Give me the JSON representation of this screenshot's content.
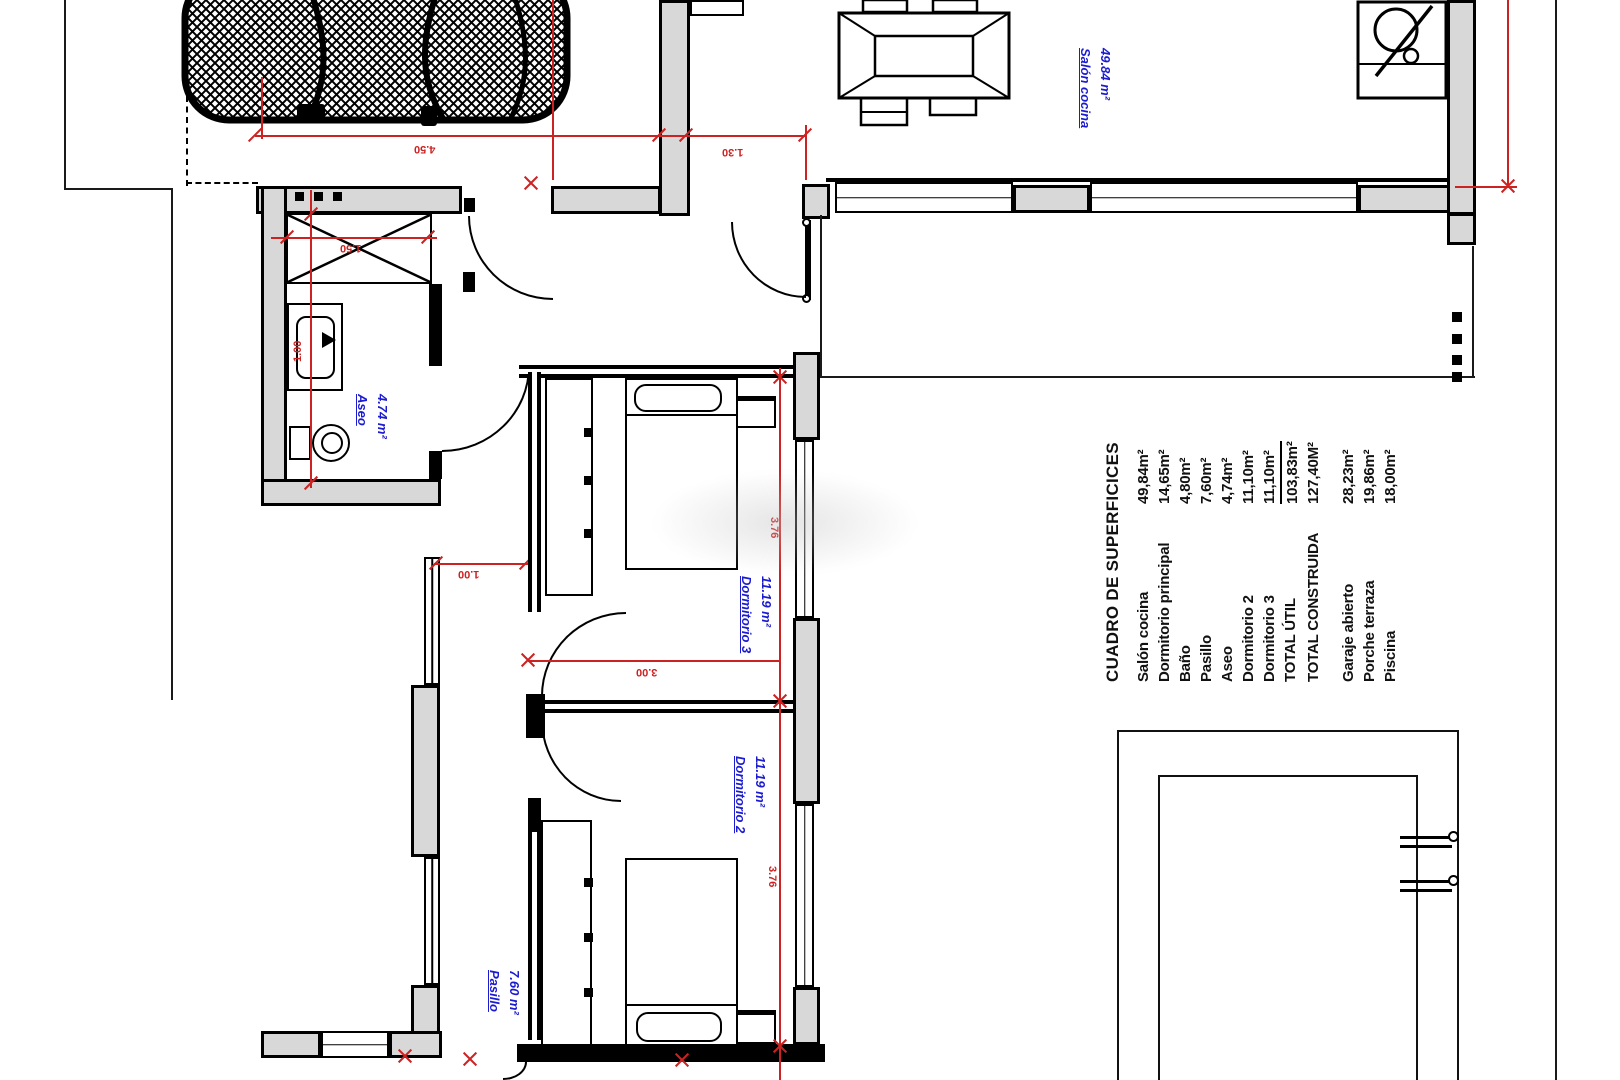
{
  "plan": {
    "rooms": {
      "salon": {
        "name": "Salón cocina",
        "area": "49.84 m²"
      },
      "aseo": {
        "name": "Aseo",
        "area": "4.74 m²"
      },
      "dormitorio3": {
        "name": "Dormitorio 3",
        "area": "11.19 m²"
      },
      "dormitorio2": {
        "name": "Dormitorio 2",
        "area": "11.19 m²"
      },
      "pasillo": {
        "name": "Pasillo",
        "area": "7.60 m²"
      }
    },
    "dimensions": {
      "garage_width": "4.50",
      "entry_width": "1.30",
      "shower_width": "1.50",
      "aseo_width": "1.00",
      "hall_width": "1.00",
      "rooms_width": "3.00",
      "dorm3_depth": "3.76",
      "dorm2_depth": "3.76"
    }
  },
  "surfaces_table": {
    "title": "CUADRO DE SUPERFICICES",
    "rows": [
      {
        "label": "Salón cocina",
        "value": "49,84m²"
      },
      {
        "label": "Dormitorio principal",
        "value": "14,65m²"
      },
      {
        "label": "Baño",
        "value": "4,80m²"
      },
      {
        "label": "Pasillo",
        "value": "7,60m²"
      },
      {
        "label": "Aseo",
        "value": "4,74m²"
      },
      {
        "label": "Dormitorio 2",
        "value": "11,10m²"
      },
      {
        "label": "Dormitorio 3",
        "value": "11,10m²"
      },
      {
        "label": "TOTAL ÚTIL",
        "value": "103,83m²"
      },
      {
        "label": "TOTAL CONSTRUIDA",
        "value": "127,40M²"
      }
    ],
    "outdoor_rows": [
      {
        "label": "Garaje abierto",
        "value": "28,23m²"
      },
      {
        "label": "Porche terraza",
        "value": "19,86m²"
      },
      {
        "label": "Piscina",
        "value": "18,00m²"
      }
    ]
  },
  "colors": {
    "wall_fill": "#d8d8d8",
    "dimension_red": "#cc2222",
    "room_label_blue": "#1b1bd1",
    "line_black": "#000000"
  }
}
